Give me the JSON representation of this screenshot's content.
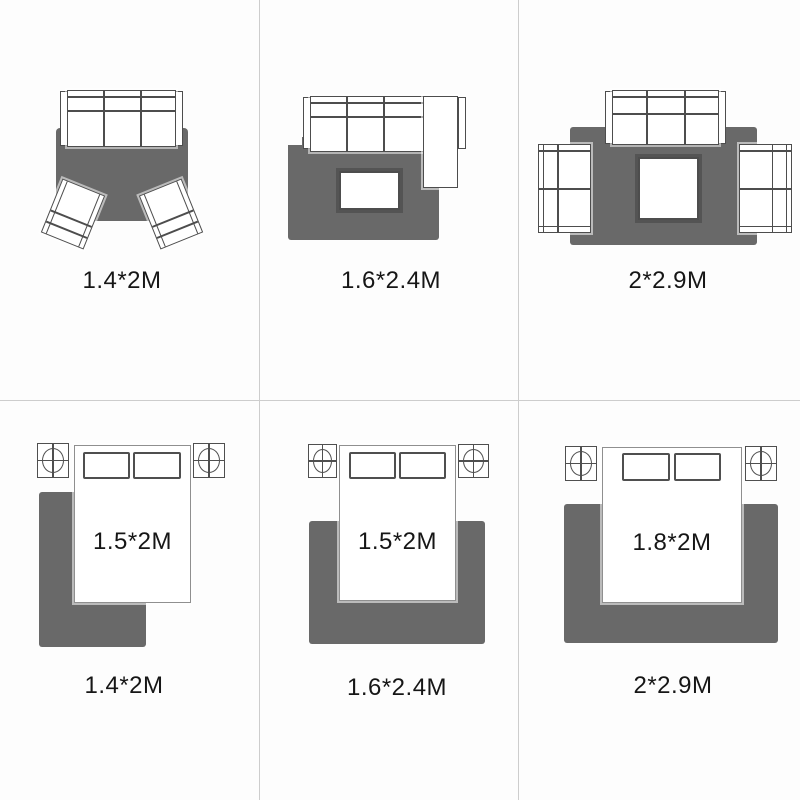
{
  "title": "Rug size guide with furniture layouts",
  "colors": {
    "background": "#fdfdfd",
    "rug": "#696969",
    "furniture_outline": "#4d4d4d",
    "bed_outline": "#8f8f8f",
    "grid_line": "#cdcdcd",
    "label_text": "#161616"
  },
  "cells": [
    {
      "id": "living-room-armchairs",
      "rug_label": "1.4*2M"
    },
    {
      "id": "living-room-sectional",
      "rug_label": "1.6*2.4M"
    },
    {
      "id": "living-room-three-piece",
      "rug_label": "2*2.9M"
    },
    {
      "id": "bedroom-small",
      "rug_label": "1.4*2M",
      "bed_label": "1.5*2M"
    },
    {
      "id": "bedroom-medium",
      "rug_label": "1.6*2.4M",
      "bed_label": "1.5*2M"
    },
    {
      "id": "bedroom-large",
      "rug_label": "2*2.9M",
      "bed_label": "1.8*2M"
    }
  ]
}
